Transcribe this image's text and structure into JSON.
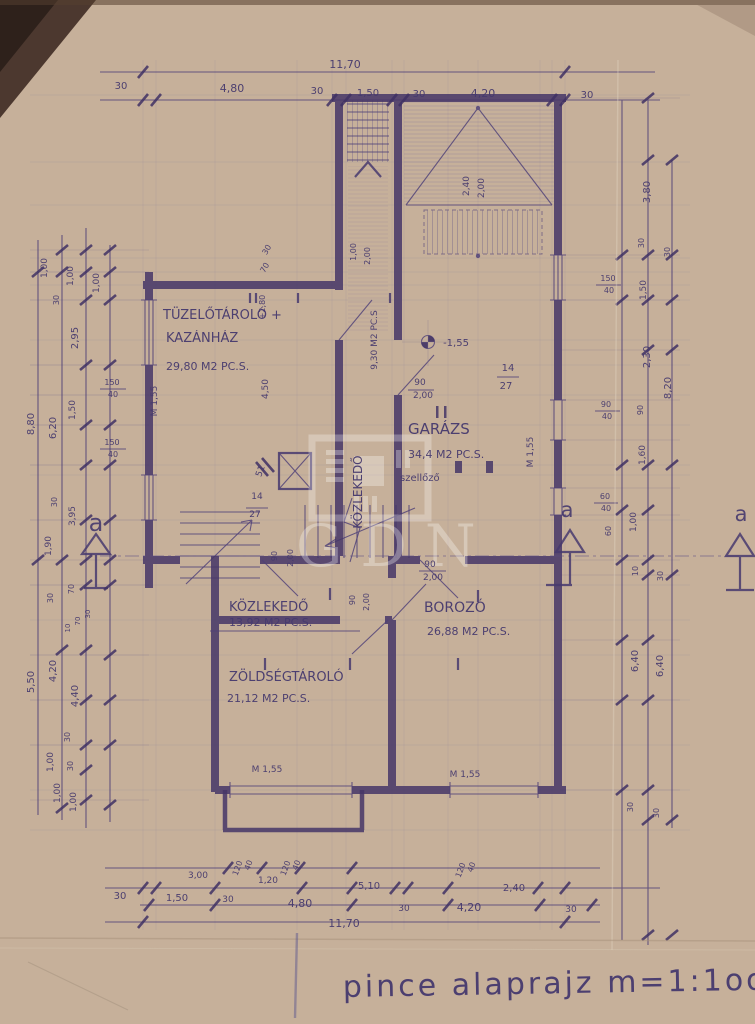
{
  "document": {
    "type": "hand-drawn basement floor plan blueprint (photograph of aged paper)",
    "caption": "pince alaprajz m=1:1oo",
    "scale": "m=1:1oo",
    "watermark": "GDN",
    "ink_color": "#473a6e",
    "paper_color": "#c6b09a"
  },
  "rooms": [
    {
      "name": "TÜZELŐTÁROLÓ + KAZÁNHÁZ",
      "area": "29,80 M2 PC.S."
    },
    {
      "name": "KÖZLEKEDŐ",
      "area": "9,30 M2 PC.S"
    },
    {
      "name": "GARÁZS",
      "area": "34,4 M2 PC.S.",
      "note": "szellőző"
    },
    {
      "name": "KÖZLEKEDŐ",
      "area": "13,92 M2 PC.S."
    },
    {
      "name": "BOROZÓ",
      "area": "26,88 M2 PC.S."
    },
    {
      "name": "ZÖLDSÉGTÁROLÓ",
      "area": "21,12 M2 PC.S."
    }
  ],
  "overall_dimensions": {
    "width": "11,70",
    "height_left": "8,80 + 5,50",
    "height_right": "8,20 + 6,40"
  },
  "annotations": [
    {
      "t": "11,70",
      "x": 345,
      "y": 68,
      "s": 11
    },
    {
      "t": "30",
      "x": 121,
      "y": 89,
      "s": 10
    },
    {
      "t": "4,80",
      "x": 232,
      "y": 92,
      "s": 11
    },
    {
      "t": "30",
      "x": 317,
      "y": 94,
      "s": 10
    },
    {
      "t": "1,50",
      "x": 368,
      "y": 96,
      "s": 10
    },
    {
      "t": "30",
      "x": 419,
      "y": 97,
      "s": 10
    },
    {
      "t": "4,20",
      "x": 483,
      "y": 97,
      "s": 11
    },
    {
      "t": "30",
      "x": 587,
      "y": 98,
      "s": 10
    },
    {
      "t": "1,00",
      "x": 47,
      "y": 268,
      "r": -90,
      "s": 9
    },
    {
      "t": "1,00",
      "x": 73,
      "y": 276,
      "r": -90,
      "s": 9
    },
    {
      "t": "1,00",
      "x": 99,
      "y": 283,
      "r": -90,
      "s": 9
    },
    {
      "t": "30",
      "x": 59,
      "y": 300,
      "r": -90,
      "s": 8
    },
    {
      "t": "2,95",
      "x": 78,
      "y": 338,
      "r": -90,
      "s": 10
    },
    {
      "t": "150",
      "x": 112,
      "y": 385,
      "s": 8
    },
    {
      "t": "40",
      "x": 113,
      "y": 397,
      "s": 8
    },
    {
      "t": "1,50",
      "x": 75,
      "y": 410,
      "r": -90,
      "s": 9
    },
    {
      "t": "8,80",
      "x": 34,
      "y": 424,
      "r": -90,
      "s": 10
    },
    {
      "t": "6,20",
      "x": 56,
      "y": 428,
      "r": -90,
      "s": 10
    },
    {
      "t": "150",
      "x": 112,
      "y": 445,
      "s": 8
    },
    {
      "t": "40",
      "x": 113,
      "y": 457,
      "s": 8
    },
    {
      "t": "30",
      "x": 57,
      "y": 502,
      "r": -90,
      "s": 8
    },
    {
      "t": "3,95",
      "x": 75,
      "y": 516,
      "r": -90,
      "s": 9
    },
    {
      "t": "1,90",
      "x": 51,
      "y": 546,
      "r": -90,
      "s": 9
    },
    {
      "t": "30",
      "x": 53,
      "y": 598,
      "r": -90,
      "s": 8
    },
    {
      "t": "70",
      "x": 74,
      "y": 589,
      "r": -90,
      "s": 8
    },
    {
      "t": "10",
      "x": 70,
      "y": 628,
      "r": -90,
      "s": 7
    },
    {
      "t": "70",
      "x": 80,
      "y": 621,
      "r": -90,
      "s": 7
    },
    {
      "t": "30",
      "x": 90,
      "y": 614,
      "r": -90,
      "s": 7
    },
    {
      "t": "5,50",
      "x": 34,
      "y": 682,
      "r": -90,
      "s": 10
    },
    {
      "t": "4,20",
      "x": 56,
      "y": 671,
      "r": -90,
      "s": 10
    },
    {
      "t": "4,40",
      "x": 78,
      "y": 696,
      "r": -90,
      "s": 10
    },
    {
      "t": "30",
      "x": 70,
      "y": 737,
      "r": -90,
      "s": 8
    },
    {
      "t": "1,00",
      "x": 53,
      "y": 762,
      "r": -90,
      "s": 9
    },
    {
      "t": "30",
      "x": 73,
      "y": 766,
      "r": -90,
      "s": 8
    },
    {
      "t": "1,00",
      "x": 60,
      "y": 793,
      "r": -90,
      "s": 9
    },
    {
      "t": "1,00",
      "x": 76,
      "y": 802,
      "r": -90,
      "s": 9
    },
    {
      "t": "3,80",
      "x": 650,
      "y": 192,
      "r": -90,
      "s": 10
    },
    {
      "t": "30",
      "x": 644,
      "y": 243,
      "r": -90,
      "s": 8
    },
    {
      "t": "30",
      "x": 670,
      "y": 252,
      "r": -90,
      "s": 8
    },
    {
      "t": "150",
      "x": 608,
      "y": 281,
      "s": 8
    },
    {
      "t": "40",
      "x": 609,
      "y": 293,
      "s": 8
    },
    {
      "t": "1,50",
      "x": 646,
      "y": 290,
      "r": -90,
      "s": 9
    },
    {
      "t": "2,30",
      "x": 650,
      "y": 357,
      "r": -90,
      "s": 10
    },
    {
      "t": "8,20",
      "x": 671,
      "y": 388,
      "r": -90,
      "s": 10
    },
    {
      "t": "90",
      "x": 606,
      "y": 407,
      "s": 8
    },
    {
      "t": "40",
      "x": 607,
      "y": 419,
      "s": 8
    },
    {
      "t": "90",
      "x": 643,
      "y": 410,
      "r": -90,
      "s": 8
    },
    {
      "t": "1,60",
      "x": 645,
      "y": 455,
      "r": -90,
      "s": 9
    },
    {
      "t": "60",
      "x": 605,
      "y": 499,
      "s": 8
    },
    {
      "t": "40",
      "x": 606,
      "y": 511,
      "s": 8
    },
    {
      "t": "60",
      "x": 611,
      "y": 531,
      "r": -90,
      "s": 8
    },
    {
      "t": "1,00",
      "x": 636,
      "y": 522,
      "r": -90,
      "s": 9
    },
    {
      "t": "10",
      "x": 638,
      "y": 571,
      "r": -90,
      "s": 8
    },
    {
      "t": "30",
      "x": 663,
      "y": 576,
      "r": -90,
      "s": 8
    },
    {
      "t": "6,40",
      "x": 638,
      "y": 661,
      "r": -90,
      "s": 10
    },
    {
      "t": "6,40",
      "x": 663,
      "y": 666,
      "r": -90,
      "s": 10
    },
    {
      "t": "30",
      "x": 633,
      "y": 807,
      "r": -90,
      "s": 8
    },
    {
      "t": "30",
      "x": 659,
      "y": 813,
      "r": -90,
      "s": 8
    },
    {
      "t": "3,00",
      "x": 198,
      "y": 878,
      "s": 9
    },
    {
      "t": "120",
      "x": 240,
      "y": 869,
      "r": -70,
      "s": 8
    },
    {
      "t": "40",
      "x": 251,
      "y": 866,
      "r": -70,
      "s": 8
    },
    {
      "t": "1,20",
      "x": 268,
      "y": 883,
      "s": 9
    },
    {
      "t": "120",
      "x": 288,
      "y": 869,
      "r": -70,
      "s": 8
    },
    {
      "t": "40",
      "x": 299,
      "y": 866,
      "r": -70,
      "s": 8
    },
    {
      "t": "30",
      "x": 120,
      "y": 899,
      "s": 10
    },
    {
      "t": "1,50",
      "x": 177,
      "y": 901,
      "s": 10
    },
    {
      "t": "30",
      "x": 228,
      "y": 902,
      "s": 9
    },
    {
      "t": "4,80",
      "x": 300,
      "y": 907,
      "s": 11
    },
    {
      "t": "5,10",
      "x": 369,
      "y": 889,
      "s": 10
    },
    {
      "t": "30",
      "x": 404,
      "y": 911,
      "s": 9
    },
    {
      "t": "120",
      "x": 463,
      "y": 871,
      "r": -70,
      "s": 8
    },
    {
      "t": "40",
      "x": 474,
      "y": 868,
      "r": -70,
      "s": 8
    },
    {
      "t": "4,20",
      "x": 469,
      "y": 911,
      "s": 11
    },
    {
      "t": "2,40",
      "x": 514,
      "y": 891,
      "s": 10
    },
    {
      "t": "30",
      "x": 571,
      "y": 912,
      "s": 9
    },
    {
      "t": "11,70",
      "x": 344,
      "y": 927,
      "s": 11
    },
    {
      "t": "TÜZELŐTÁROLÓ +",
      "x": 163,
      "y": 319,
      "s": 13,
      "a": "start",
      "n": "room-label-tuzelotarolo"
    },
    {
      "t": "KAZÁNHÁZ",
      "x": 166,
      "y": 342,
      "s": 13,
      "a": "start",
      "n": "room-label-kazanhaz"
    },
    {
      "t": "29,80 M2 PC.S.",
      "x": 166,
      "y": 370,
      "s": 11,
      "a": "start",
      "n": "room-area-kazanhaz"
    },
    {
      "t": "KÖZLEKEDŐ",
      "x": 362,
      "y": 492,
      "r": -90,
      "s": 12,
      "n": "room-label-kozlekedo-upper"
    },
    {
      "t": "9,30 M2 PC.S",
      "x": 377,
      "y": 340,
      "r": -90,
      "s": 9,
      "n": "room-area-kozlekedo-upper"
    },
    {
      "t": "1,00",
      "x": 356,
      "y": 252,
      "r": -90,
      "s": 8
    },
    {
      "t": "2,00",
      "x": 370,
      "y": 256,
      "r": -90,
      "s": 8
    },
    {
      "t": "30",
      "x": 269,
      "y": 251,
      "r": -60,
      "s": 8
    },
    {
      "t": "70",
      "x": 267,
      "y": 269,
      "r": -60,
      "s": 8
    },
    {
      "t": "+2,80",
      "x": 265,
      "y": 307,
      "r": -90,
      "s": 8
    },
    {
      "t": "4,50",
      "x": 268,
      "y": 389,
      "r": -90,
      "s": 9
    },
    {
      "t": "M 1,55",
      "x": 157,
      "y": 401,
      "r": -90,
      "s": 9
    },
    {
      "t": "2,40",
      "x": 469,
      "y": 186,
      "r": -90,
      "s": 9
    },
    {
      "t": "2,00",
      "x": 484,
      "y": 188,
      "r": -90,
      "s": 9
    },
    {
      "t": "-1,55",
      "x": 456,
      "y": 346,
      "s": 10,
      "n": "level-mark-value"
    },
    {
      "t": "14",
      "x": 508,
      "y": 371,
      "s": 10
    },
    {
      "t": "27",
      "x": 506,
      "y": 389,
      "s": 10
    },
    {
      "t": "GARÁZS",
      "x": 408,
      "y": 434,
      "s": 15,
      "a": "start",
      "n": "room-label-garazs"
    },
    {
      "t": "34,4 M2 PC.S.",
      "x": 408,
      "y": 458,
      "s": 11,
      "a": "start",
      "n": "room-area-garazs"
    },
    {
      "t": "szellőző",
      "x": 400,
      "y": 481,
      "s": 10,
      "a": "start",
      "n": "vent-label"
    },
    {
      "t": "M 1,55",
      "x": 533,
      "y": 452,
      "r": -90,
      "s": 9
    },
    {
      "t": "90",
      "x": 420,
      "y": 385,
      "s": 9
    },
    {
      "t": "2,00",
      "x": 423,
      "y": 398,
      "s": 9
    },
    {
      "t": "51",
      "x": 263,
      "y": 472,
      "r": -70,
      "s": 9
    },
    {
      "t": "14",
      "x": 257,
      "y": 499,
      "s": 9
    },
    {
      "t": "27",
      "x": 255,
      "y": 517,
      "s": 9
    },
    {
      "t": "90",
      "x": 277,
      "y": 556,
      "r": -90,
      "s": 8
    },
    {
      "t": "2,00",
      "x": 293,
      "y": 558,
      "r": -90,
      "s": 8
    },
    {
      "t": "90",
      "x": 430,
      "y": 567,
      "s": 9
    },
    {
      "t": "2,00",
      "x": 433,
      "y": 580,
      "s": 9
    },
    {
      "t": "90",
      "x": 355,
      "y": 600,
      "r": -90,
      "s": 8
    },
    {
      "t": "2,00",
      "x": 369,
      "y": 602,
      "r": -90,
      "s": 8
    },
    {
      "t": "KÖZLEKEDŐ",
      "x": 229,
      "y": 611,
      "s": 13,
      "a": "start",
      "n": "room-label-kozlekedo-lower"
    },
    {
      "t": "13,92 M2 PC.S.",
      "x": 229,
      "y": 626,
      "s": 11,
      "a": "start",
      "n": "room-area-kozlekedo-lower"
    },
    {
      "t": "BOROZÓ",
      "x": 424,
      "y": 612,
      "s": 14,
      "a": "start",
      "n": "room-label-borozo"
    },
    {
      "t": "26,88 M2 PC.S.",
      "x": 427,
      "y": 635,
      "s": 11,
      "a": "start",
      "n": "room-area-borozo"
    },
    {
      "t": "ZÖLDSÉGTÁROLÓ",
      "x": 229,
      "y": 681,
      "s": 13,
      "a": "start",
      "n": "room-label-zoldsegtarolo"
    },
    {
      "t": "21,12 M2 PC.S.",
      "x": 227,
      "y": 702,
      "s": 11,
      "a": "start",
      "n": "room-area-zoldsegtarolo"
    },
    {
      "t": "M 1,55",
      "x": 267,
      "y": 772,
      "s": 9
    },
    {
      "t": "M 1,55",
      "x": 465,
      "y": 777,
      "s": 9
    },
    {
      "t": "a",
      "x": 96,
      "y": 531,
      "s": 24,
      "n": "section-marker-letter",
      "cls": "marker"
    },
    {
      "t": "a",
      "x": 567,
      "y": 517,
      "s": 21,
      "n": "section-marker-letter",
      "cls": "marker"
    },
    {
      "t": "a",
      "x": 741,
      "y": 521,
      "s": 21,
      "n": "section-marker-letter",
      "cls": "marker"
    }
  ]
}
